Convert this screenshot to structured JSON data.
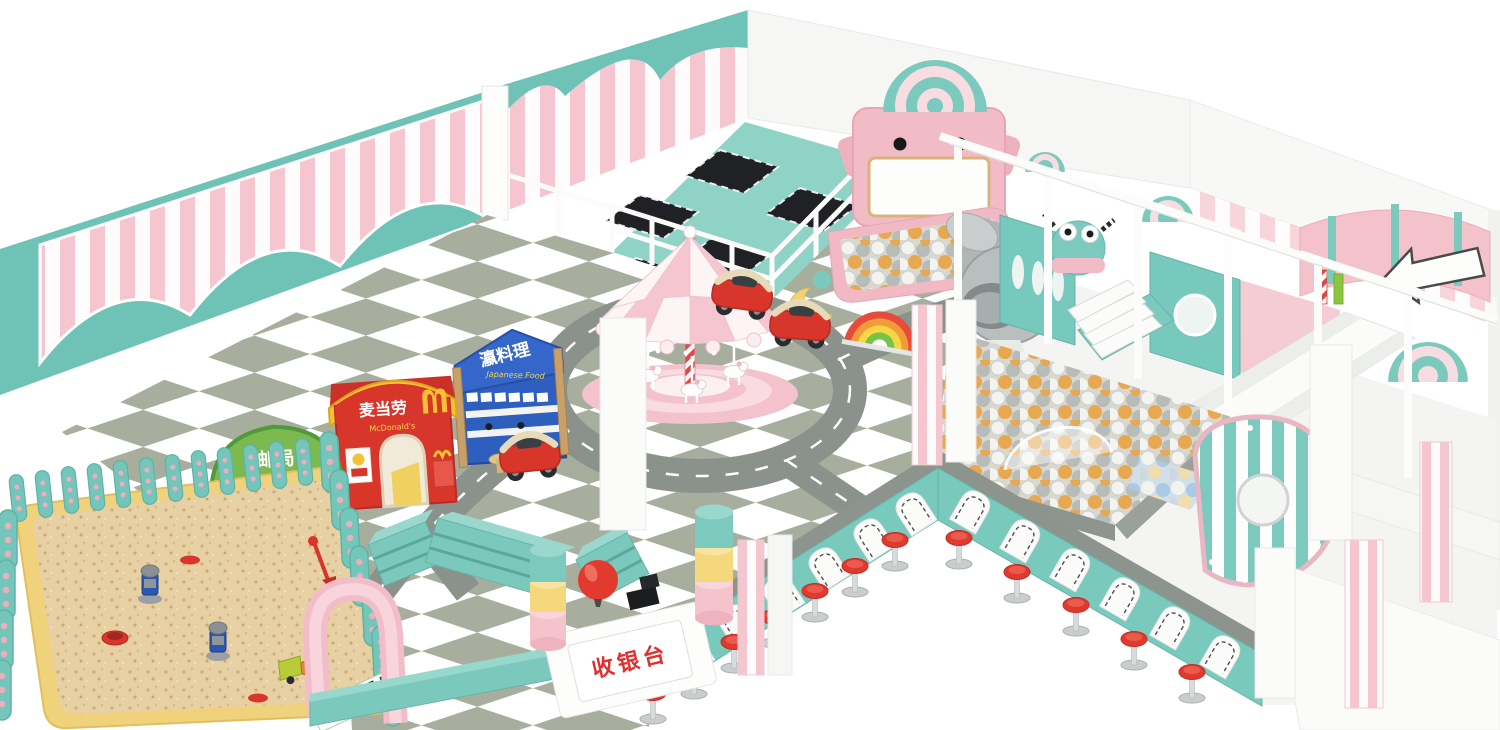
{
  "signs": {
    "post_office": {
      "cn": "邮局",
      "en": "POST OFFICE"
    },
    "mcdonalds": {
      "cn": "麦当劳",
      "en": "McDonald's"
    },
    "japanese_food": {
      "cn": "瀛料理",
      "en": "Japanese Food"
    },
    "cashier": {
      "cn": "收银台"
    }
  },
  "colors": {
    "teal": "#74c7bb",
    "teal_dark": "#5fb2a6",
    "mint_floor": "#8ed3c6",
    "pink": "#f4c3cc",
    "pink_stripe": "#f5c6cf",
    "sage_tile": "#a8ae9e",
    "road_gray": "#8b918b",
    "sand": "#e7d0a4",
    "sand_border": "#f0d27c",
    "red": "#e0392e",
    "mcdonalds_red": "#d8352b",
    "mcdonalds_yellow": "#f4c233",
    "post_office_green": "#7cb94e",
    "japanese_blue": "#2e5fbe",
    "ball_white": "#f3f3f0",
    "ball_gray": "#b7bcb8",
    "ball_orange": "#e7a84f",
    "trampoline_black": "#1f2124"
  }
}
